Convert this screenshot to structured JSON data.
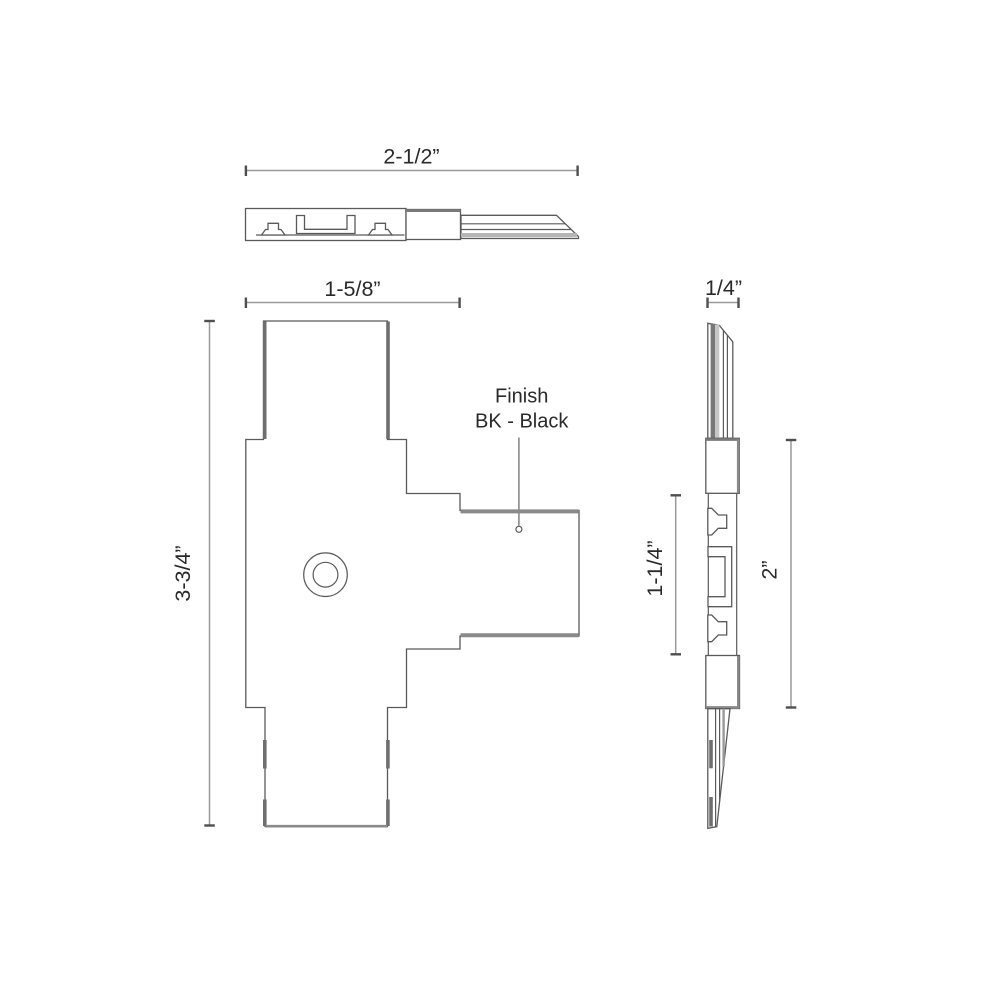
{
  "drawing": {
    "kind": "technical-drawing",
    "views": {
      "top": {
        "dim_width": "2-1/2”"
      },
      "front": {
        "dim_width": "1-5/8”",
        "dim_height": "3-3/4”",
        "finish_note_line1": "Finish",
        "finish_note_line2": "BK - Black"
      },
      "side": {
        "dim_thickness": "1/4”",
        "dim_inner_height": "1-1/4”",
        "dim_height": "2”"
      }
    },
    "colors": {
      "outline": "#5a5a5a",
      "thick_edge": "#8a8a8a",
      "dark_bar": "#6e6e6e",
      "dim_line": "#9a9a9a",
      "band": "#b5b5b5",
      "text": "#2a2a2a",
      "background": "#ffffff"
    }
  }
}
